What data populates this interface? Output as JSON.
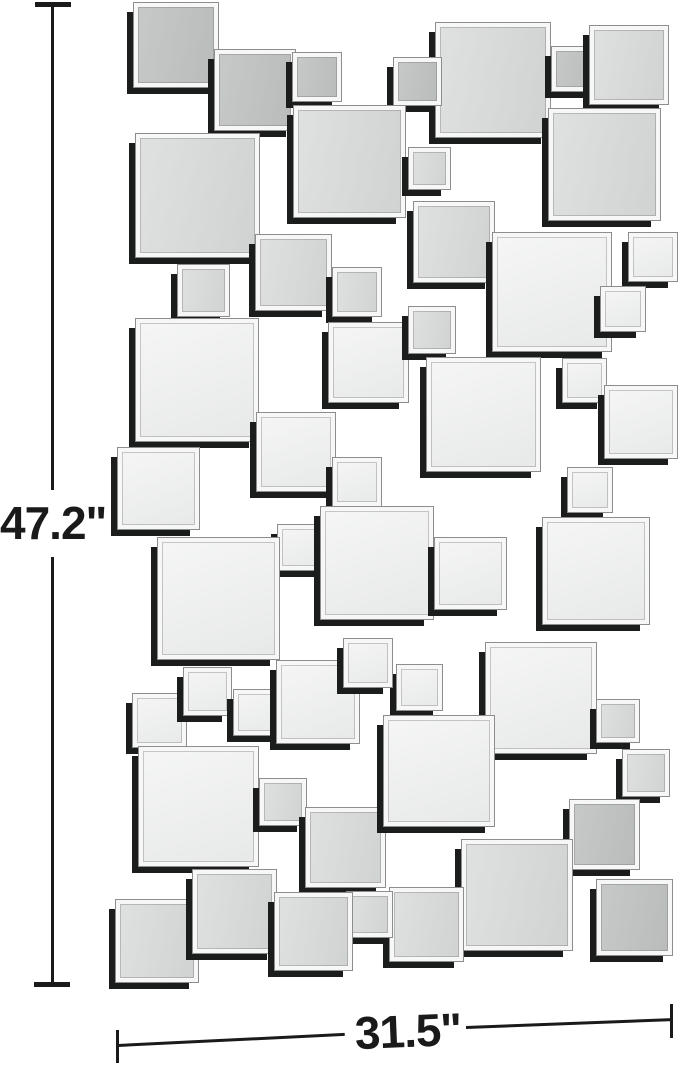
{
  "product": {
    "name": "beveled-square-mirrored-wall-decor",
    "background": "#ffffff"
  },
  "dimensions": {
    "height_label": "47.2\"",
    "width_label": "31.5\"",
    "line_color": "#1a1a1a"
  },
  "mirror": {
    "colors": {
      "shadow": "#1b1d1c",
      "bevel": "#f6f7f6",
      "outline": "#8d8d8d",
      "face_gray": "#bfc2c1",
      "face_mid": "#d9dbda",
      "face_white": "#eff1f0"
    },
    "tiles": [
      {
        "x": 133,
        "y": 2,
        "s": 86,
        "shade": "g"
      },
      {
        "x": 214,
        "y": 49,
        "s": 82,
        "shade": "g"
      },
      {
        "x": 292,
        "y": 52,
        "s": 50,
        "shade": "g"
      },
      {
        "x": 435,
        "y": 22,
        "s": 116,
        "shade": "m"
      },
      {
        "x": 551,
        "y": 46,
        "s": 46,
        "shade": "g"
      },
      {
        "x": 589,
        "y": 25,
        "s": 80,
        "shade": "m"
      },
      {
        "x": 393,
        "y": 57,
        "s": 49,
        "shade": "g"
      },
      {
        "x": 293,
        "y": 105,
        "s": 113,
        "shade": "m"
      },
      {
        "x": 548,
        "y": 108,
        "s": 113,
        "shade": "m"
      },
      {
        "x": 135,
        "y": 133,
        "s": 125,
        "shade": "m"
      },
      {
        "x": 408,
        "y": 147,
        "s": 43,
        "shade": "m"
      },
      {
        "x": 628,
        "y": 232,
        "s": 50,
        "shade": "w"
      },
      {
        "x": 413,
        "y": 201,
        "s": 82,
        "shade": "m"
      },
      {
        "x": 255,
        "y": 234,
        "s": 77,
        "shade": "m"
      },
      {
        "x": 492,
        "y": 232,
        "s": 120,
        "shade": "w"
      },
      {
        "x": 177,
        "y": 264,
        "s": 53,
        "shade": "m"
      },
      {
        "x": 332,
        "y": 267,
        "s": 50,
        "shade": "m"
      },
      {
        "x": 600,
        "y": 286,
        "s": 46,
        "shade": "w"
      },
      {
        "x": 135,
        "y": 318,
        "s": 124,
        "shade": "w"
      },
      {
        "x": 328,
        "y": 322,
        "s": 81,
        "shade": "w"
      },
      {
        "x": 408,
        "y": 306,
        "s": 48,
        "shade": "m"
      },
      {
        "x": 562,
        "y": 358,
        "s": 45,
        "shade": "w"
      },
      {
        "x": 604,
        "y": 385,
        "s": 74,
        "shade": "w"
      },
      {
        "x": 426,
        "y": 357,
        "s": 115,
        "shade": "w"
      },
      {
        "x": 256,
        "y": 412,
        "s": 80,
        "shade": "w"
      },
      {
        "x": 332,
        "y": 457,
        "s": 50,
        "shade": "w"
      },
      {
        "x": 567,
        "y": 467,
        "s": 46,
        "shade": "w"
      },
      {
        "x": 117,
        "y": 447,
        "s": 83,
        "shade": "w"
      },
      {
        "x": 277,
        "y": 524,
        "s": 47,
        "shade": "w"
      },
      {
        "x": 320,
        "y": 506,
        "s": 114,
        "shade": "w"
      },
      {
        "x": 157,
        "y": 537,
        "s": 123,
        "shade": "w"
      },
      {
        "x": 434,
        "y": 537,
        "s": 73,
        "shade": "w"
      },
      {
        "x": 542,
        "y": 517,
        "s": 108,
        "shade": "w"
      },
      {
        "x": 396,
        "y": 664,
        "s": 47,
        "shade": "w"
      },
      {
        "x": 132,
        "y": 693,
        "s": 55,
        "shade": "w"
      },
      {
        "x": 183,
        "y": 667,
        "s": 49,
        "shade": "w"
      },
      {
        "x": 233,
        "y": 689,
        "s": 47,
        "shade": "w"
      },
      {
        "x": 276,
        "y": 660,
        "s": 84,
        "shade": "w"
      },
      {
        "x": 343,
        "y": 638,
        "s": 50,
        "shade": "w"
      },
      {
        "x": 485,
        "y": 642,
        "s": 112,
        "shade": "w"
      },
      {
        "x": 596,
        "y": 699,
        "s": 44,
        "shade": "m"
      },
      {
        "x": 622,
        "y": 749,
        "s": 48,
        "shade": "m"
      },
      {
        "x": 138,
        "y": 746,
        "s": 121,
        "shade": "w"
      },
      {
        "x": 259,
        "y": 778,
        "s": 48,
        "shade": "m"
      },
      {
        "x": 305,
        "y": 807,
        "s": 81,
        "shade": "m"
      },
      {
        "x": 383,
        "y": 715,
        "s": 112,
        "shade": "w"
      },
      {
        "x": 569,
        "y": 799,
        "s": 71,
        "shade": "g"
      },
      {
        "x": 461,
        "y": 839,
        "s": 112,
        "shade": "m"
      },
      {
        "x": 389,
        "y": 887,
        "s": 75,
        "shade": "m"
      },
      {
        "x": 346,
        "y": 891,
        "s": 47,
        "shade": "m"
      },
      {
        "x": 115,
        "y": 899,
        "s": 84,
        "shade": "m"
      },
      {
        "x": 192,
        "y": 869,
        "s": 85,
        "shade": "m"
      },
      {
        "x": 274,
        "y": 892,
        "s": 79,
        "shade": "m"
      },
      {
        "x": 596,
        "y": 879,
        "s": 77,
        "shade": "g"
      }
    ]
  }
}
